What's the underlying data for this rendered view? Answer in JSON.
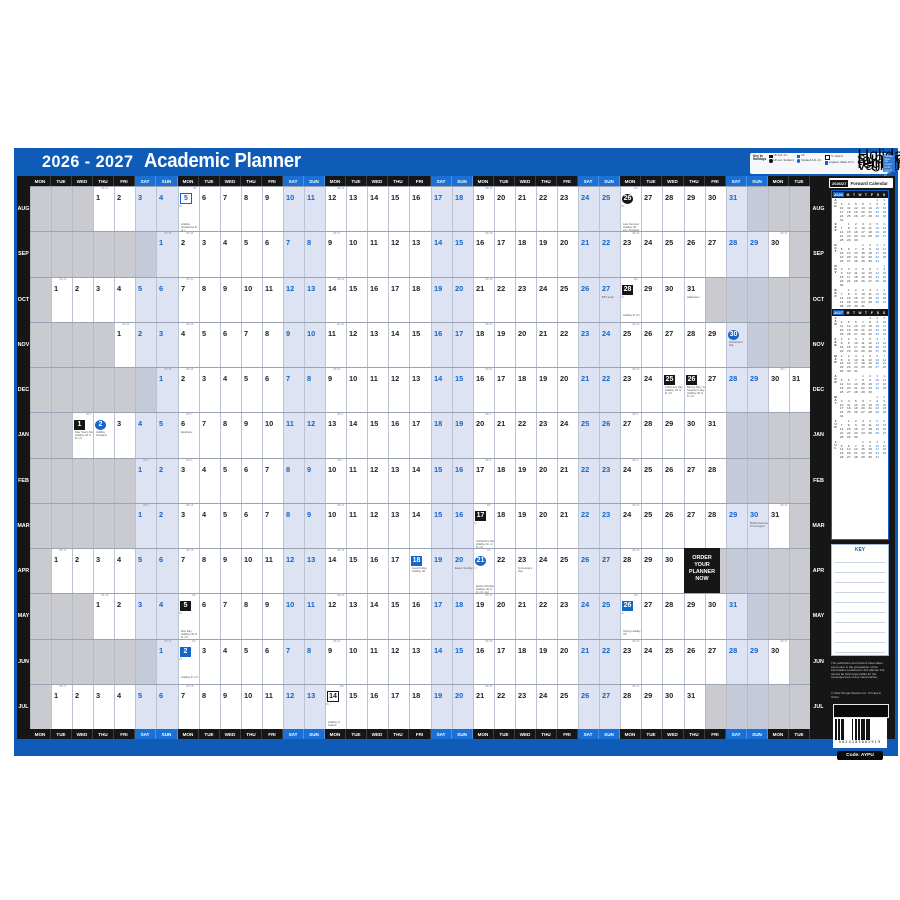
{
  "header": {
    "years": "2026 - 2027",
    "title": "Academic Planner"
  },
  "legend": {
    "title": "Key to Holidays",
    "items": [
      {
        "style": "black-square",
        "label": "UK & R. of I."
      },
      {
        "style": "black-circle",
        "label": "UK exc. Scotland"
      },
      {
        "style": "blue-square",
        "label": "UK"
      },
      {
        "style": "blue-circle",
        "label": "Scotland & R. of I."
      },
      {
        "style": "white-square",
        "label": "N. Ireland"
      },
      {
        "style": "blue-square",
        "label": "England, Wales & N.I."
      }
    ],
    "note": "Holidays subject to regional variation",
    "footnote": "Holiday dates are correct at the time of going to press"
  },
  "day_names": [
    "MON",
    "TUE",
    "WED",
    "THU",
    "FRI",
    "SAT",
    "SUN"
  ],
  "week_numbering": {
    "start": 31,
    "wrap_after": 52,
    "marker_prefix": "Wk"
  },
  "months": [
    {
      "label": "AUG",
      "start_col": 4,
      "days": 31,
      "events": [
        {
          "day": 5,
          "badge": "blue-outline",
          "note": "Holiday Scotland & R. of I."
        },
        {
          "day": 26,
          "badge": "black-circle",
          "note": "Late Summer Holiday UK exc. Scotland"
        }
      ]
    },
    {
      "label": "SEP",
      "start_col": 7,
      "days": 30,
      "events": []
    },
    {
      "label": "OCT",
      "start_col": 2,
      "days": 31,
      "events": [
        {
          "day": 27,
          "note": "BST ends"
        },
        {
          "day": 28,
          "badge": "black-square",
          "note": "Holiday R. of I."
        },
        {
          "day": 31,
          "note": "Halloween"
        }
      ]
    },
    {
      "label": "NOV",
      "start_col": 5,
      "days": 30,
      "events": [
        {
          "day": 30,
          "badge": "blue-circle",
          "note": "St Andrew's Day"
        }
      ]
    },
    {
      "label": "DEC",
      "start_col": 7,
      "days": 31,
      "events": [
        {
          "day": 25,
          "badge": "black-square",
          "note": "Christmas Day Holiday UK & R. of I."
        },
        {
          "day": 26,
          "badge": "black-square",
          "note": "Boxing Day / St Stephen's Day Holiday UK & R. of I."
        }
      ]
    },
    {
      "label": "JAN",
      "start_col": 3,
      "days": 31,
      "events": [
        {
          "day": 1,
          "badge": "black-square",
          "note": "New Year's Day Holiday UK & R. of I."
        },
        {
          "day": 2,
          "badge": "blue-circle",
          "note": "Holiday Scotland"
        },
        {
          "day": 6,
          "note": "Epiphany"
        }
      ]
    },
    {
      "label": "FEB",
      "start_col": 6,
      "days": 28,
      "events": []
    },
    {
      "label": "MAR",
      "start_col": 6,
      "days": 31,
      "events": [
        {
          "day": 17,
          "badge": "black-square",
          "note": "St Patrick's Day Holiday N.I. & R. of I."
        },
        {
          "day": 30,
          "note": "British Summer Time begins"
        }
      ]
    },
    {
      "label": "APR",
      "start_col": 2,
      "days": 30,
      "events": [
        {
          "day": 18,
          "badge": "blue-square",
          "note": "Good Friday Holiday UK"
        },
        {
          "day": 20,
          "note": "Easter Sunday"
        },
        {
          "day": 21,
          "badge": "blue-circle",
          "note": "Easter Monday Holiday UK & R. of I. exc. Scotland"
        },
        {
          "day": 23,
          "note": "St George's Day"
        }
      ]
    },
    {
      "label": "MAY",
      "start_col": 4,
      "days": 31,
      "events": [
        {
          "day": 5,
          "badge": "black-square",
          "note": "May Day Holiday UK & R. of I."
        },
        {
          "day": 26,
          "badge": "blue-square",
          "note": "Spring Holiday UK"
        }
      ]
    },
    {
      "label": "JUN",
      "start_col": 7,
      "days": 30,
      "events": [
        {
          "day": 2,
          "badge": "blue-square",
          "note": "Holiday R. of I."
        }
      ]
    },
    {
      "label": "JUL",
      "start_col": 2,
      "days": 31,
      "events": [
        {
          "day": 14,
          "badge": "white-square",
          "note": "Holiday N. Ireland"
        }
      ]
    }
  ],
  "order_box": {
    "month_index": 8,
    "start_col": 32,
    "col_span": 1.7,
    "lines": [
      "ORDER",
      "YOUR",
      "PLANNER",
      "NOW"
    ]
  },
  "side_panel": {
    "title_tab": "2026/27",
    "title": "Forward Calendar",
    "mini_day_letters": [
      "M",
      "T",
      "W",
      "T",
      "F",
      "S",
      "S"
    ],
    "years": [
      {
        "year": "2026",
        "months": [
          {
            "label": "AUG",
            "offset": 5,
            "days": 31
          },
          {
            "label": "SEP",
            "offset": 1,
            "days": 30
          },
          {
            "label": "OCT",
            "offset": 3,
            "days": 31
          },
          {
            "label": "NOV",
            "offset": 6,
            "days": 30
          },
          {
            "label": "DEC",
            "offset": 1,
            "days": 31
          }
        ]
      },
      {
        "year": "2027",
        "months": [
          {
            "label": "JAN",
            "offset": 4,
            "days": 31
          },
          {
            "label": "FEB",
            "offset": 0,
            "days": 28
          },
          {
            "label": "MAR",
            "offset": 0,
            "days": 31
          },
          {
            "label": "APR",
            "offset": 3,
            "days": 30
          },
          {
            "label": "MAY",
            "offset": 5,
            "days": 31
          },
          {
            "label": "JUN",
            "offset": 1,
            "days": 30
          },
          {
            "label": "JUL",
            "offset": 3,
            "days": 31
          }
        ]
      }
    ],
    "key_title": "KEY",
    "key_lines": 10,
    "disclaimer": "The publishers and printers have taken every care in the preparation of the information contained in this planner but cannot be held responsible for the consequences of any inaccuracies.",
    "copyright": "© 2012 Simply Diaries Ltd · Printed in China",
    "barcode_digits": "5024103002919",
    "code_label": "Code: AYPU"
  }
}
